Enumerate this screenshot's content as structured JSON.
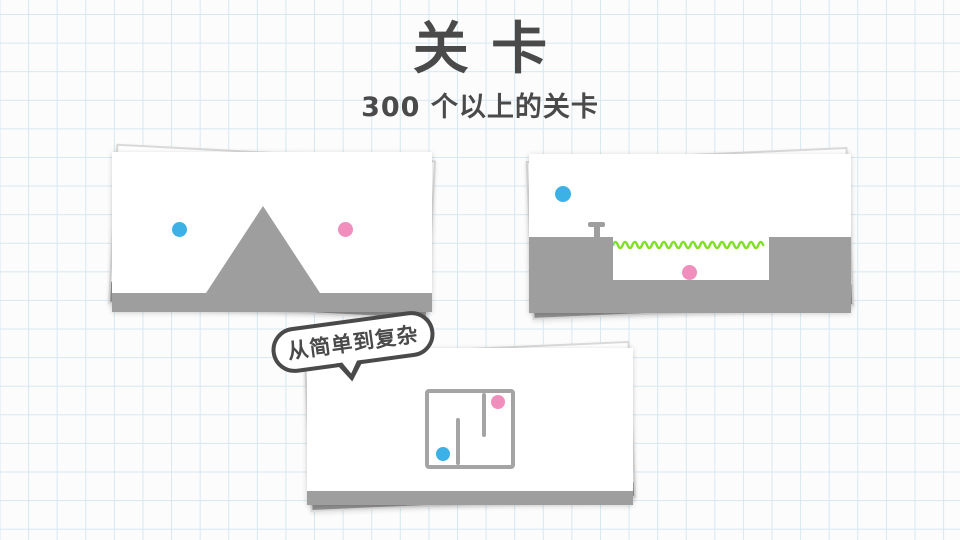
{
  "header": {
    "title": "关卡",
    "subtitle": "300 个以上的关卡"
  },
  "bubble": {
    "label": "从简单到复杂"
  },
  "cards": [
    {
      "id": "triangle-level",
      "elements": [
        "blue-dot",
        "pink-dot",
        "triangle-obstacle",
        "ground-floor"
      ]
    },
    {
      "id": "water-pit-level",
      "elements": [
        "blue-dot",
        "plunger",
        "water-wave",
        "pink-dot",
        "ground-ledges",
        "pit-floor"
      ]
    },
    {
      "id": "maze-level",
      "elements": [
        "maze-outline",
        "maze-walls",
        "pink-dot",
        "blue-dot",
        "ground-floor"
      ]
    }
  ],
  "colors": {
    "ink": "#4a4a4a",
    "obstacle_gray": "#9e9e9e",
    "back_gray": "#8f8f8f",
    "dot_blue": "#3bb1e6",
    "dot_pink": "#f08fbe",
    "wave_green": "#7fdf25",
    "maze_gray": "#a4a4a4",
    "grid_line": "#d6e8f2",
    "bg": "#fcfcfc",
    "card_border": "#d9d9d9"
  }
}
